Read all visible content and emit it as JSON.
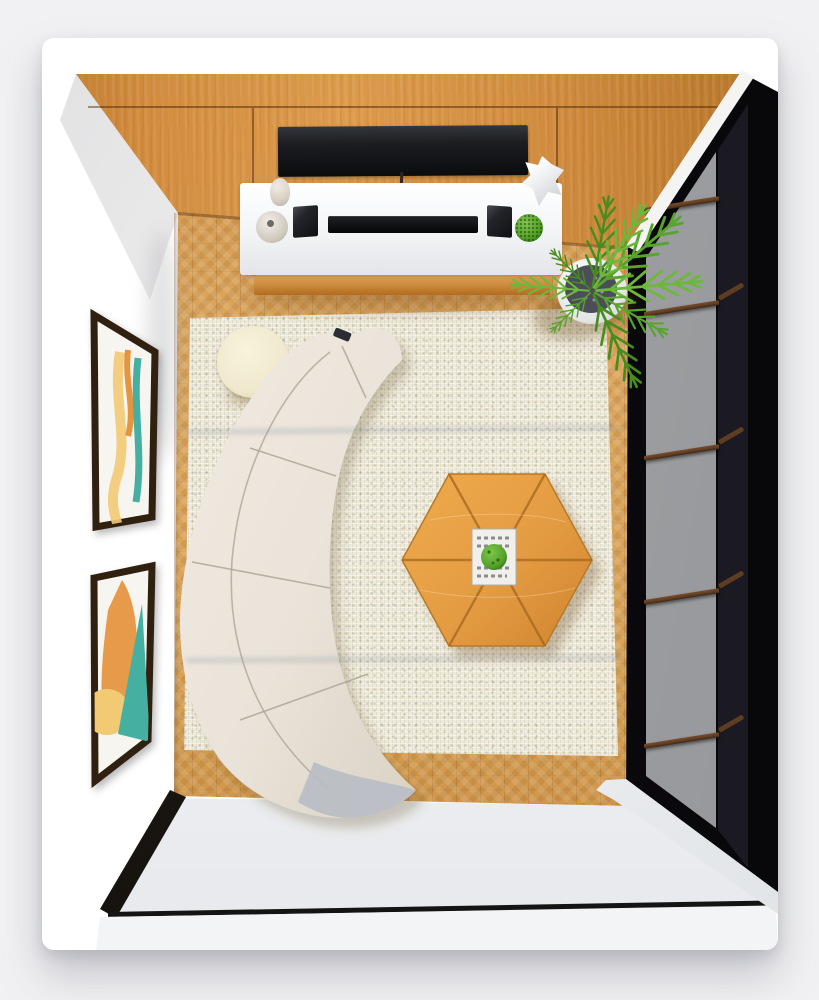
{
  "meta": {
    "title": "Top-down 3D render of a modern living room",
    "view": "bird's-eye interior visualization",
    "room_type": "living room"
  },
  "palette": {
    "page_bg": "#f1f1f3",
    "card": "#ffffff",
    "wood": "#d28c3e",
    "wood_dark": "#b97427",
    "floor": "#d9a458",
    "floor_dark": "#c4873d",
    "rug": "#ece9dd",
    "sofa": "#e9e3d9",
    "sofa_shade": "#d8d1c4",
    "sofa_gray": "#b8bcc4",
    "hex_table": "#e39b41",
    "side_table": "#f0e9cf",
    "console": "#f2f4f6",
    "console_wood": "#cd8a3c",
    "tv": "#1b1d21",
    "device_black": "#0f1013",
    "window_frame": "#0f0d12",
    "glass": "#a0a2a4",
    "glass_dark": "#2c2a33",
    "mullion": "#5d3c22",
    "sill": "#eef0f2",
    "baseboard": "#17130f",
    "art_frame": "#30200f",
    "art_teal": "#45b0a2",
    "art_orange": "#e6953f",
    "art_yellow": "#f2ca74",
    "leaf": "#58a42c",
    "leaf_light": "#6cb83a",
    "leaf_dark": "#478c1e",
    "pot": "#ffffff",
    "pebbles": "#4b4e59",
    "vase": "#d8d0c5",
    "tray": "#f0efec",
    "tray_plant": "#54a02a"
  },
  "scene": {
    "walls": {
      "top": "wood panel wall with inset TV",
      "left": "white gallery wall with two framed prints",
      "right": "black-framed window wall with gray glazing",
      "bottom": "white wall with dark baseboard"
    },
    "furniture": [
      {
        "id": "curved-sofa",
        "label": "Curved modular sofa, off-white, 4 segments"
      },
      {
        "id": "hexagon-coffee-table",
        "label": "Hexagonal wood coffee table, 6 radial seams"
      },
      {
        "id": "round-side-table",
        "label": "Round cream side table"
      },
      {
        "id": "media-console",
        "label": "White media console with wood base"
      }
    ],
    "electronics": [
      {
        "id": "tv",
        "label": "Wall-inset flat TV"
      },
      {
        "id": "soundbar",
        "label": "Black soundbar"
      },
      {
        "id": "speaker-left",
        "label": "Bookshelf speaker"
      },
      {
        "id": "speaker-right",
        "label": "Bookshelf speaker"
      }
    ],
    "decor": [
      {
        "id": "area-rug",
        "label": "Cream boucle area rug"
      },
      {
        "id": "palm-plant",
        "label": "Potted palm in white planter with dark pebbles"
      },
      {
        "id": "console-plant",
        "label": "Small round green plant"
      },
      {
        "id": "vase-small",
        "label": "Small ceramic vase"
      },
      {
        "id": "vase-big",
        "label": "Round ceramic vase"
      },
      {
        "id": "paper-sculpture",
        "label": "White faceted sculpture"
      },
      {
        "id": "wall-art-top",
        "label": "Abstract print, teal/orange/yellow waves"
      },
      {
        "id": "wall-art-bottom",
        "label": "Abstract print, orange blob and teal wedge"
      },
      {
        "id": "coffee-table-tray",
        "label": "Magazine tray with small green plant"
      },
      {
        "id": "remote",
        "label": "Remote control on sofa arm"
      }
    ],
    "window": {
      "panes": 2,
      "mullions": 5,
      "glazing": "gray",
      "frame": "black with walnut mullions"
    }
  }
}
